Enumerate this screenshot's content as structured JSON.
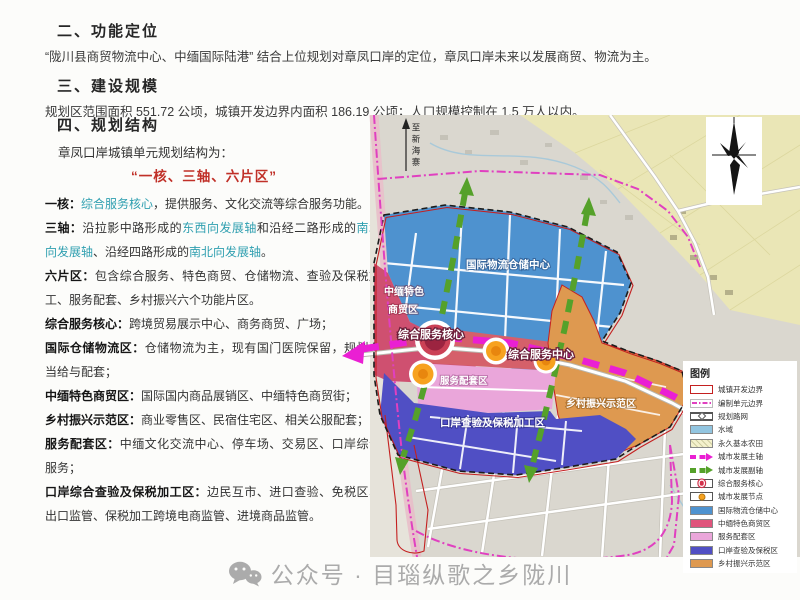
{
  "header": {
    "section2": {
      "title": "二、功能定位",
      "body": "“陇川县商贸物流中心、中缅国际陆港” 结合上位规划对章凤口岸的定位，章凤口岸未来以发展商贸、物流为主。"
    },
    "section3": {
      "title": "三、建设规模",
      "body": "规划区范围面积 551.72 公顷，城镇开发边界内面积 186.19 公顷；人口规模控制在 1.5 万人以内。"
    }
  },
  "section4": {
    "title": "四、规划结构",
    "intro": "章凤口岸城镇单元规划结构为：",
    "slogan": "“一核、三轴、六片区”",
    "one_core": {
      "label": "一核：",
      "term": "综合服务核心",
      "rest": "，提供服务、文化交流等综合服务功能。"
    },
    "three_axes": {
      "label": "三轴：",
      "t1": "沿拉影中路形成的",
      "term1": "东西向发展轴",
      "t2": "和沿经二路形成的",
      "term2": "南北向发展轴",
      "t3": "、沿经四路形成的",
      "term3": "南北向发展轴",
      "t4": "。"
    },
    "six_zones": {
      "label": "六片区：",
      "rest": "包含综合服务、特色商贸、仓储物流、查验及保税加工、服务配套、乡村振兴六个功能片区。"
    },
    "zones": [
      {
        "label": "综合服务核心：",
        "rest": "跨境贸易展示中心、商务商贸、广场；"
      },
      {
        "label": "国际仓储物流区：",
        "rest": "仓储物流为主，现有国门医院保留，规划适当给与配套；"
      },
      {
        "label": "中缅特色商贸区：",
        "rest": "国际国内商品展销区、中缅特色商贸街；"
      },
      {
        "label": "乡村振兴示范区：",
        "rest": "商业零售区、民宿住宅区、相关公服配套；"
      },
      {
        "label": "服务配套区：",
        "rest": "中缅文化交流中心、停车场、交易区、口岸综合服务；"
      },
      {
        "label": "口岸综合查验及保税加工区：",
        "rest": "边民互市、进口查验、免税区、出口监管、保税加工跨境电商监管、进境商品监管。"
      }
    ]
  },
  "map": {
    "labels": {
      "logistics": "国际物流仓储中心",
      "commerce_line1": "中缅特色",
      "commerce_line2": "商贸区",
      "core": "综合服务核心",
      "center": "综合服务中心",
      "service": "服务配套区",
      "customs": "口岸查验及保税加工区",
      "rural": "乡村振兴示范区",
      "road_to": "至新海寨"
    },
    "legend": {
      "title": "图例",
      "items": [
        {
          "label": "城镇开发边界",
          "type": "boundary-red",
          "color": "#c42020"
        },
        {
          "label": "编制单元边界",
          "type": "boundary-magenta",
          "color": "#e040c0"
        },
        {
          "label": "规划路网",
          "type": "road",
          "color": "#555555"
        },
        {
          "label": "水域",
          "type": "fill",
          "color": "#92c5e0"
        },
        {
          "label": "永久基本农田",
          "type": "fill-hatch",
          "color": "#f4f1cc"
        },
        {
          "label": "城市发展主轴",
          "type": "axis-magenta",
          "color": "#ea1fd3"
        },
        {
          "label": "城市发展副轴",
          "type": "axis-green",
          "color": "#55a12a"
        },
        {
          "label": "综合服务核心",
          "type": "node-red",
          "color": "#d2304a"
        },
        {
          "label": "城市发展节点",
          "type": "node-orange",
          "color": "#f7a21f"
        },
        {
          "label": "国际物流仓储中心",
          "type": "fill",
          "color": "#4e92cf"
        },
        {
          "label": "中缅特色商贸区",
          "type": "fill",
          "color": "#e0547c"
        },
        {
          "label": "服务配套区",
          "type": "fill",
          "color": "#eaa6da"
        },
        {
          "label": "口岸查验及保税区",
          "type": "fill",
          "color": "#504fc4"
        },
        {
          "label": "乡村振兴示范区",
          "type": "fill",
          "color": "#de9950"
        }
      ]
    }
  },
  "footer": {
    "watermark": "公众号 · 目瑙纵歌之乡陇川"
  },
  "colors": {
    "term_teal": "#2f9fb0",
    "slogan_red": "#c03028",
    "axis_magenta": "#ea1fd3",
    "axis_green": "#55a12a",
    "unit_boundary_magenta": "#e040c0",
    "dev_boundary_red": "#c42020",
    "zone_logistics": "#4e92cf",
    "zone_commerce": "#cf5070",
    "zone_service": "#eaa6da",
    "zone_customs": "#504fc4",
    "zone_rural": "#de9950"
  }
}
